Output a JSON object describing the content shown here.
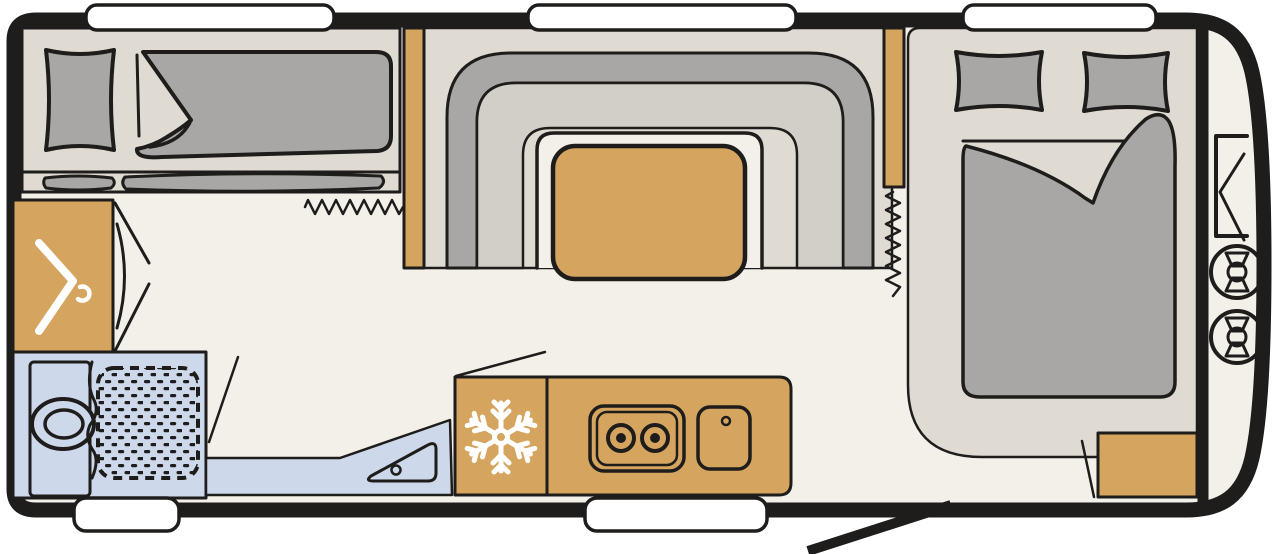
{
  "diagram": {
    "type": "caravan-floor-plan",
    "view": "top-down layout drawing, no text labels",
    "areas": [
      {
        "id": "bunk-room",
        "meaning": "transverse bunk beds with pillow and duvet, rear left"
      },
      {
        "id": "wardrobe",
        "meaning": "wardrobe cabinet with clothes-hook symbol"
      },
      {
        "id": "washroom",
        "meaning": "washroom with toilet, vanity and shower tray"
      },
      {
        "id": "lounge",
        "meaning": "U-shaped lounge seating around a table, center"
      },
      {
        "id": "kitchen",
        "meaning": "kitchen block with fridge, two-burner hob and sink"
      },
      {
        "id": "bedroom",
        "meaning": "double bed with two pillows and folded duvet, front right"
      },
      {
        "id": "front-locker",
        "meaning": "front gas locker with two gas bottles"
      }
    ],
    "icons": [
      {
        "name": "snowflake-icon",
        "meaning": "refrigerator"
      },
      {
        "name": "clothes-hanger-icon",
        "meaning": "wardrobe"
      },
      {
        "name": "toilet-icon",
        "meaning": "toilet bowl"
      },
      {
        "name": "shower-tray-icon",
        "meaning": "shower with dotted tray"
      },
      {
        "name": "hob-icon",
        "meaning": "gas hob",
        "burners": 2
      },
      {
        "name": "sink-icon",
        "meaning": "kitchen sink with tap dot"
      },
      {
        "name": "gas-bottle-icon",
        "meaning": "gas bottle seen from above",
        "count": 2
      },
      {
        "name": "gas-locker-bracket-icon",
        "meaning": "front locker fitting"
      },
      {
        "name": "curtain-zigzag-icon",
        "meaning": "privacy curtain",
        "count": 2
      },
      {
        "name": "door-swing-icon",
        "meaning": "open door indication",
        "count": 3
      }
    ],
    "counts": {
      "windows_top": 3,
      "windows_bottom": 2,
      "gas_bottles": 2,
      "hob_burners": 2,
      "beds": 2,
      "pillows_double_bed": 2
    },
    "entrance": "door leaf drawn open at the front right of the bottom wall"
  },
  "palette": {
    "bg": "#ffffff",
    "ink": "#1e1d1b",
    "floor": "#f3f0e9",
    "platform": "#dfdbd3",
    "upholstery": "#a8a7a5",
    "seat": "#d2cec8",
    "wood": "#d5a560",
    "wet": "#cdd8ea",
    "white": "#ffffff"
  }
}
